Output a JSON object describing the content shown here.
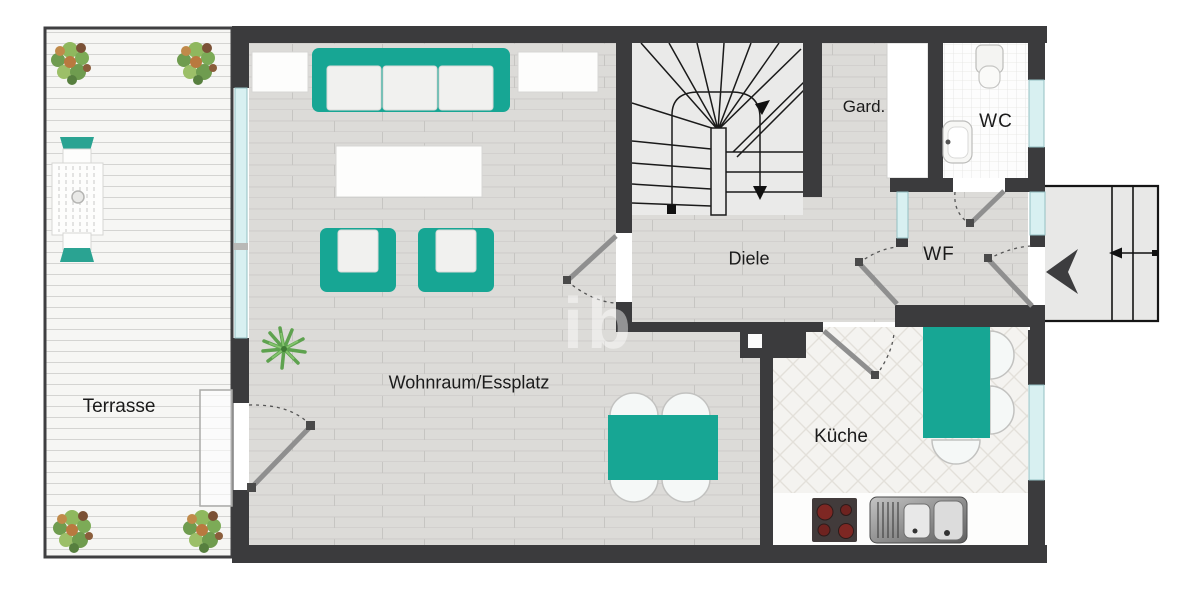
{
  "plan": {
    "title": "Erdgeschoss Grundriss (floor plan)",
    "rooms": [
      {
        "id": "terrasse",
        "label": "Terrasse"
      },
      {
        "id": "wohnraum",
        "label": "Wohnraum/Essplatz"
      },
      {
        "id": "diele",
        "label": "Diele"
      },
      {
        "id": "gard",
        "label": "Gard."
      },
      {
        "id": "wc",
        "label": "WC"
      },
      {
        "id": "wf",
        "label": "WF"
      },
      {
        "id": "kueche",
        "label": "Küche"
      }
    ],
    "watermark": "ib",
    "colors": {
      "wall": "#3b3b3d",
      "furniture_teal": "#17a694",
      "window_glass": "#d8f0f1",
      "door_leaf": "#8f8f8f",
      "floor_gray": "#dcdbd8",
      "terrace_floor": "#f6f6f4",
      "kitchen_floor": "#f4f3f0",
      "wc_tile": "#fdfdfd",
      "stair_floor": "#eaeae9",
      "entry_platform": "#e8e8e7",
      "burner_red": "#7e2723",
      "plant_green": "#8fb85e"
    },
    "symbols": {
      "entry_arrow": "entry-direction-arrow-left",
      "stair_down_arrow": "stairs-walk-line-down-arrow",
      "stair_start_marker": "stairs-walk-line-start-square",
      "shaft_symbol": "wall-shaft-square"
    }
  }
}
